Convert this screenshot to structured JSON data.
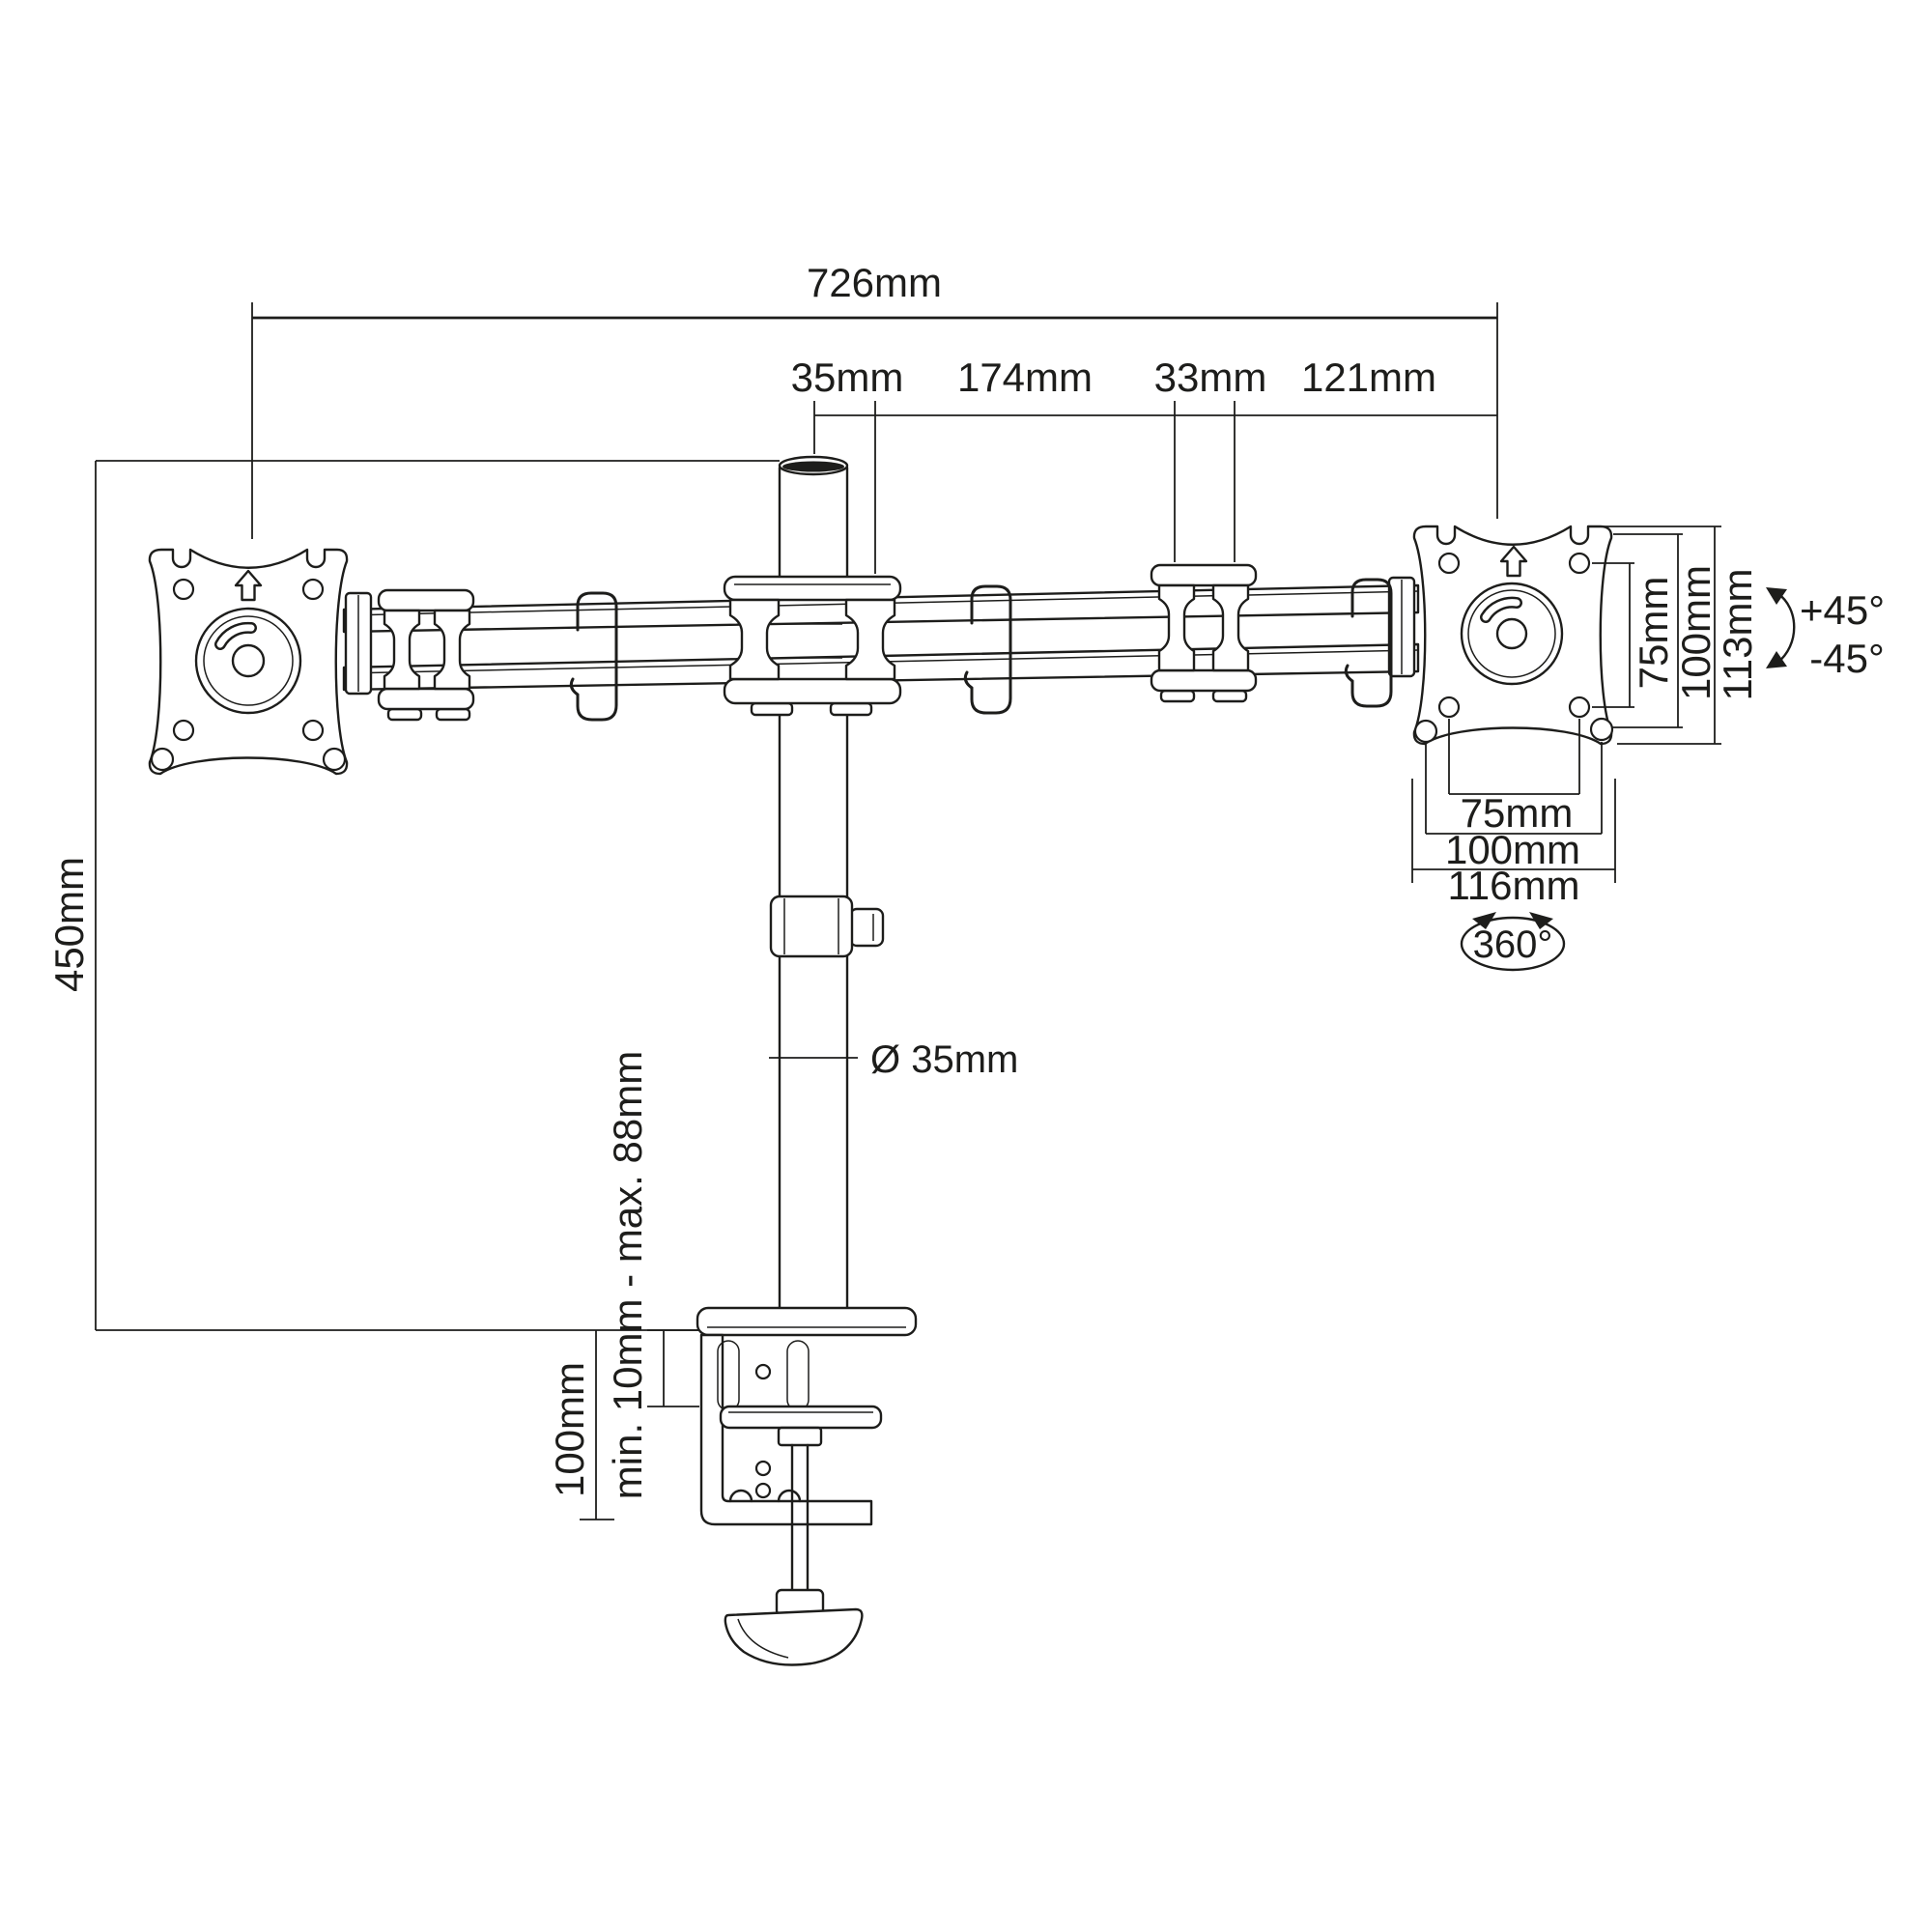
{
  "colors": {
    "ink": "#1d1d1b",
    "background": "#ffffff"
  },
  "dimensions": {
    "top": {
      "total": "726mm",
      "pole": "35mm",
      "arm": "174mm",
      "joint": "33mm",
      "end": "121mm"
    },
    "left": {
      "height": "450mm",
      "clamp_height": "100mm",
      "clamp_range": "min. 10mm - max. 88mm",
      "pole_diameter": "Ø 35mm"
    },
    "vesa_vertical": {
      "inner": "75mm",
      "outer": "100mm",
      "plate": "113mm"
    },
    "vesa_horizontal": {
      "inner": "75mm",
      "outer": "100mm",
      "plate": "116mm"
    },
    "rotation": {
      "tilt_up": "+45°",
      "tilt_down": "-45°",
      "swivel": "360°"
    }
  }
}
